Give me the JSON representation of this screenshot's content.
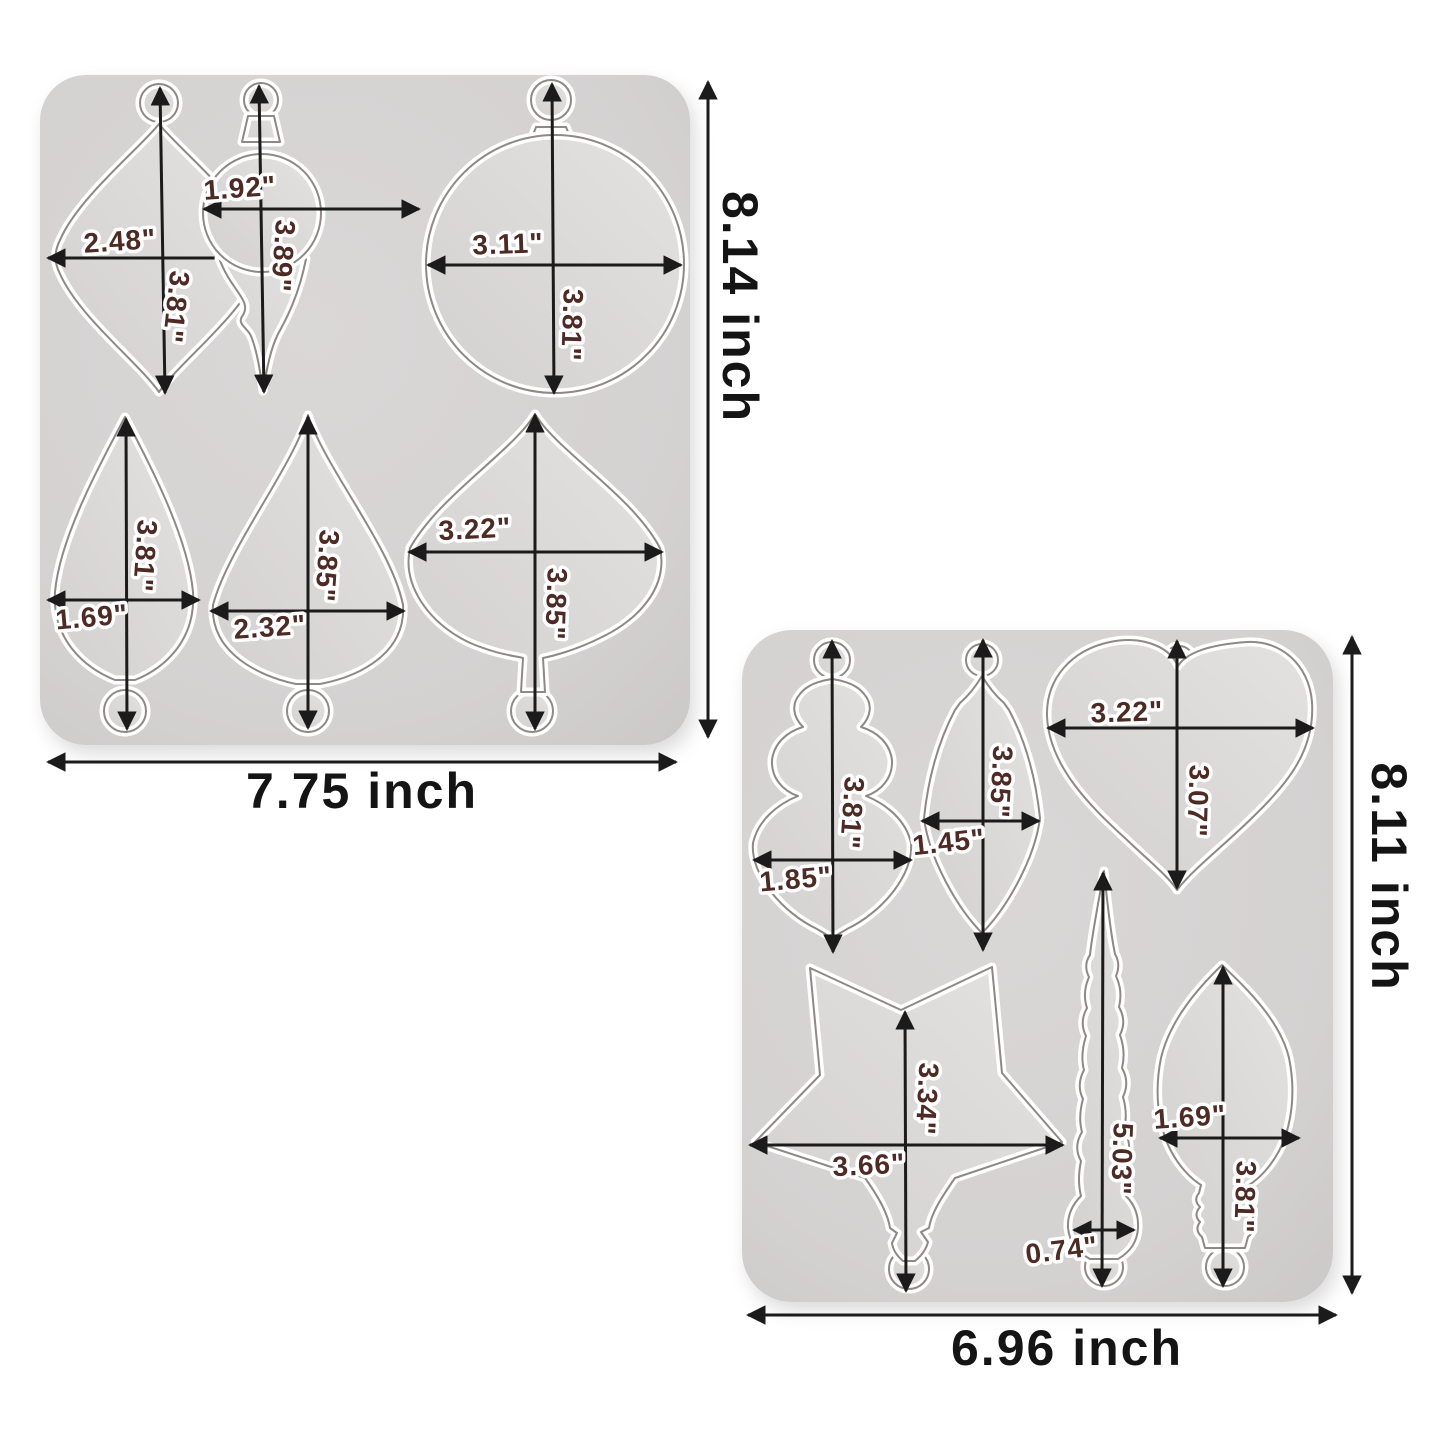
{
  "image_type": "silicone-mold-dimension-diagram",
  "colors": {
    "background": "#ffffff",
    "mold_surface": "#d5d2d2",
    "cavity_fill": "#dddbda",
    "cavity_rim": "#ffffff",
    "seam_line": "#8f8886",
    "dimension_line": "#1b1b1b",
    "measure_text": "#4e2a24",
    "outer_text": "#141414"
  },
  "molds": [
    {
      "name": "mold-1",
      "width_label": "7.75 inch",
      "height_label": "8.14 inch",
      "shapes": [
        {
          "name": "marquise-ornament",
          "width": "2.48\"",
          "height": "3.81\""
        },
        {
          "name": "ball-spiral-drop",
          "width": "1.92\"",
          "height": "3.89\""
        },
        {
          "name": "round-ball-ornament",
          "width": "3.11\"",
          "height": "3.81\""
        },
        {
          "name": "teardrop-small",
          "width": "1.69\"",
          "height": "3.81\""
        },
        {
          "name": "teardrop-large",
          "width": "2.32\"",
          "height": "3.85\""
        },
        {
          "name": "onion-finial",
          "width": "3.22\"",
          "height": "3.85\""
        }
      ]
    },
    {
      "name": "mold-2",
      "width_label": "6.96 inch",
      "height_label": "8.11 inch",
      "shapes": [
        {
          "name": "tiered-finial",
          "width": "1.85\"",
          "height": "3.81\""
        },
        {
          "name": "kite-drop",
          "width": "1.45\"",
          "height": "3.85\""
        },
        {
          "name": "heart",
          "width": "3.22\"",
          "height": "3.07\""
        },
        {
          "name": "star",
          "width": "3.66\"",
          "height": "3.34\""
        },
        {
          "name": "icicle",
          "width": "0.74\"",
          "height": "5.03\""
        },
        {
          "name": "light-bulb",
          "width": "1.69\"",
          "height": "3.81\""
        }
      ]
    }
  ]
}
